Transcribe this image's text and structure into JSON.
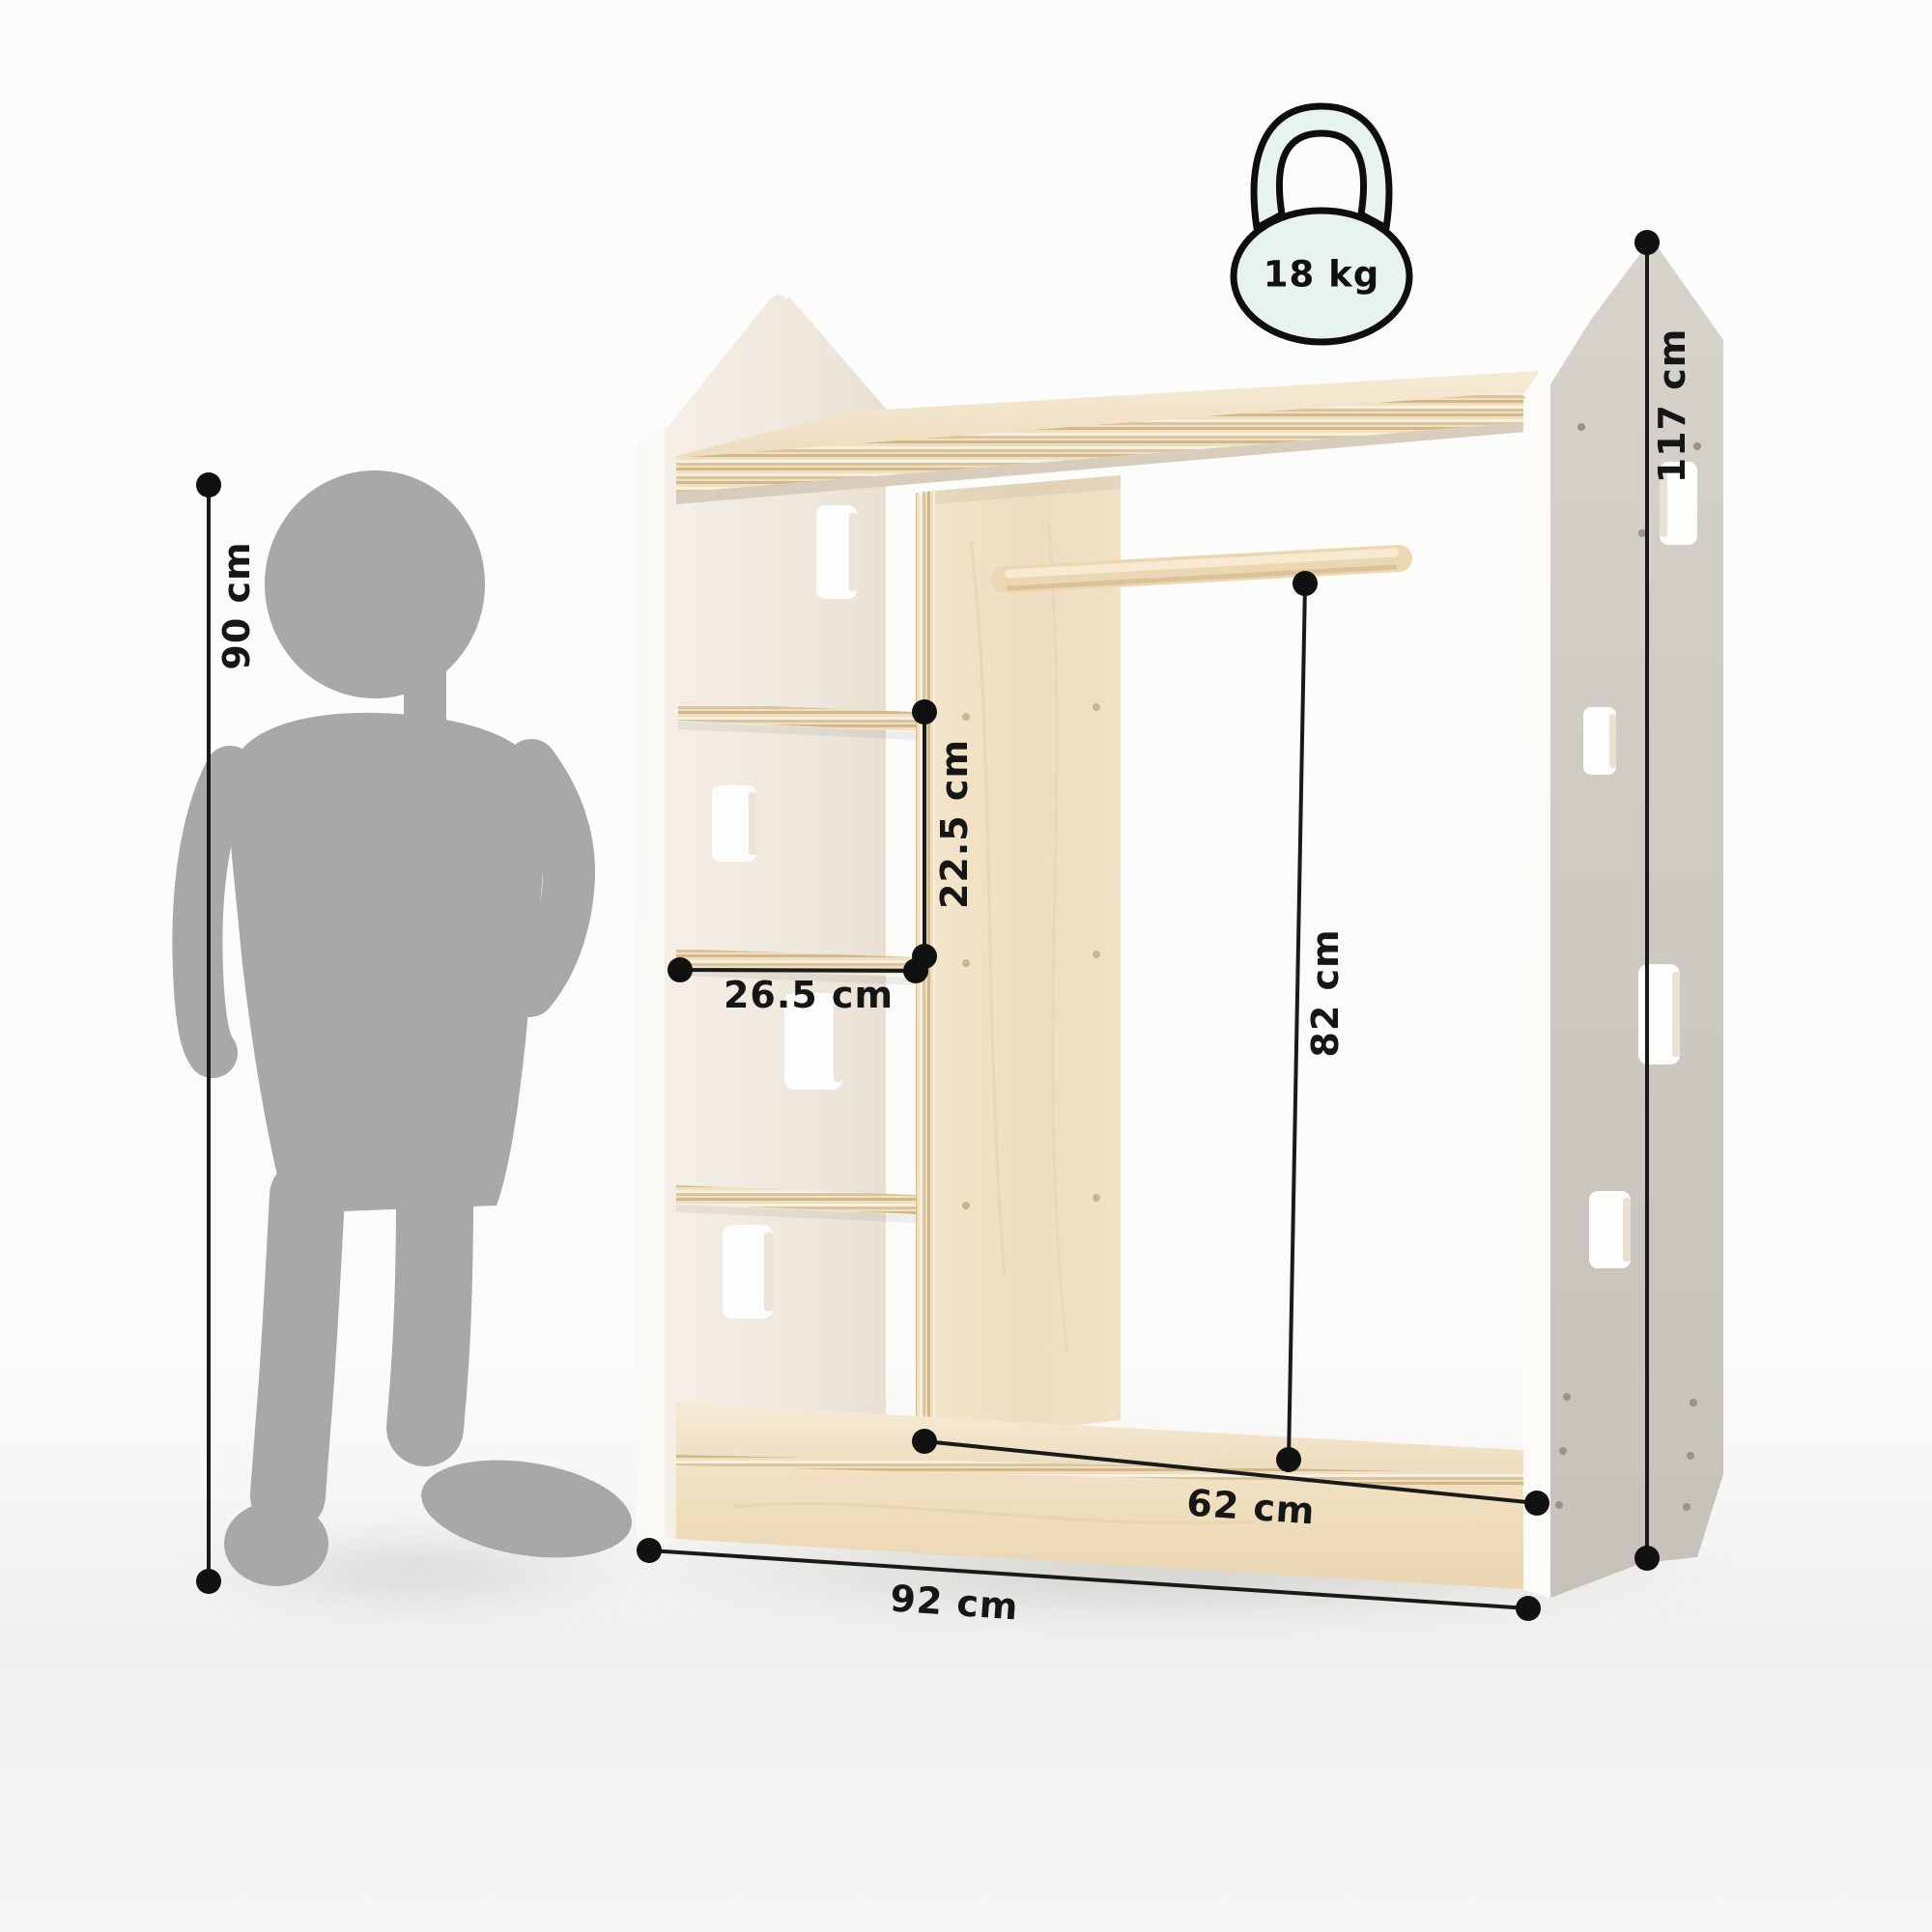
{
  "weight_badge": {
    "value": "18 kg",
    "fill": "#e7f3f1"
  },
  "dimensions": {
    "child_height": "90 cm",
    "side_height": "117 cm",
    "shelf_gap": "22.5 cm",
    "shelf_width": "26.5 cm",
    "rod_height": "82 cm",
    "inner_width": "62 cm",
    "total_width": "92 cm"
  },
  "colors": {
    "dimension_line": "#1a1a1a",
    "silhouette_gray": "#a8a8a8",
    "panel_cream": "#f0e9df",
    "panel_gray": "#cdcac3",
    "wood_birch": "#f0e1c4",
    "badge_mint": "#e7f3f1"
  }
}
